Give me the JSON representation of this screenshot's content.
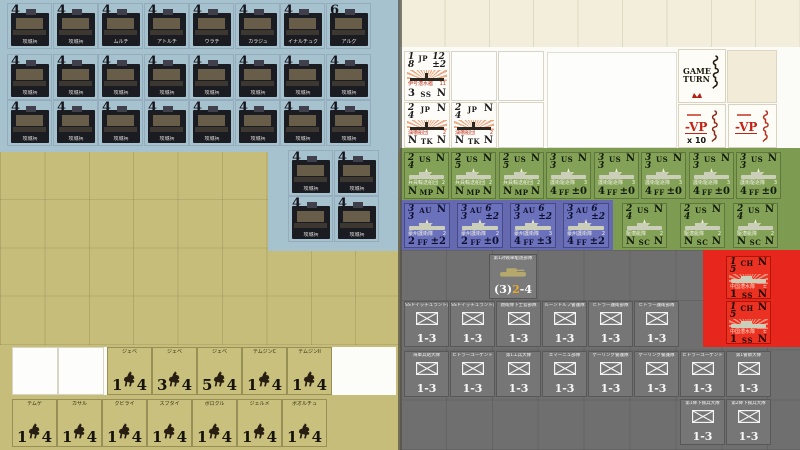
{
  "colors": {
    "blue": "#a7c2cf",
    "tan": "#c6bd7a",
    "cream": "#f3eedb",
    "green": "#7d9c51",
    "purple": "#656ab0",
    "gray": "#6f6f6f",
    "red": "#e7271d",
    "vp_red": "#c32218",
    "stat_yellow": "#e8a928"
  },
  "siege": {
    "row1": [
      {
        "v": "4",
        "name": "攻城兵"
      },
      {
        "v": "4",
        "name": "攻城兵"
      },
      {
        "v": "4",
        "name": "ムルチ"
      },
      {
        "v": "4",
        "name": "アトルチ"
      },
      {
        "v": "4",
        "name": "ウラチ"
      },
      {
        "v": "4",
        "name": "カラジュ"
      },
      {
        "v": "4",
        "name": "イナルチュク"
      },
      {
        "v": "6",
        "name": "アルグ"
      }
    ],
    "row2": [
      {
        "v": "4",
        "name": "攻城兵"
      },
      {
        "v": "4",
        "name": "攻城兵"
      },
      {
        "v": "4",
        "name": "攻城兵"
      },
      {
        "v": "4",
        "name": "攻城兵"
      },
      {
        "v": "4",
        "name": "攻城兵"
      },
      {
        "v": "4",
        "name": "攻城兵"
      },
      {
        "v": "4",
        "name": "攻城兵"
      },
      {
        "v": "4",
        "name": "攻城兵"
      }
    ],
    "row3": [
      {
        "v": "4",
        "name": "攻城兵"
      },
      {
        "v": "4",
        "name": "攻城兵"
      },
      {
        "v": "4",
        "name": "攻城兵"
      },
      {
        "v": "4",
        "name": "攻城兵"
      },
      {
        "v": "4",
        "name": "攻城兵"
      },
      {
        "v": "4",
        "name": "攻城兵"
      },
      {
        "v": "4",
        "name": "攻城兵"
      },
      {
        "v": "4",
        "name": "攻城兵"
      }
    ],
    "ext": [
      {
        "v": "4",
        "name": "攻城兵"
      },
      {
        "v": "4",
        "name": "攻城兵"
      },
      {
        "v": "4",
        "name": "攻城兵"
      },
      {
        "v": "4",
        "name": "攻城兵"
      }
    ]
  },
  "cavalry": {
    "row1": [
      {
        "name": "ジェベ",
        "a": "1",
        "m": "4"
      },
      {
        "name": "ジェベ",
        "a": "3",
        "m": "4"
      },
      {
        "name": "ジェベ",
        "a": "5",
        "m": "4"
      },
      {
        "name": "テムジンC",
        "a": "1",
        "m": "4"
      },
      {
        "name": "テムジンII",
        "a": "1",
        "m": "4"
      }
    ],
    "row2": [
      {
        "name": "テムゲ",
        "a": "1",
        "m": "4"
      },
      {
        "name": "カサル",
        "a": "1",
        "m": "4"
      },
      {
        "name": "クビライ",
        "a": "1",
        "m": "4"
      },
      {
        "name": "スブタイ",
        "a": "1",
        "m": "4"
      },
      {
        "name": "ボロクル",
        "a": "1",
        "m": "4"
      },
      {
        "name": "ジェルメ",
        "a": "1",
        "m": "4"
      },
      {
        "name": "ボオルチュ",
        "a": "1",
        "m": "4"
      }
    ]
  },
  "naval": {
    "jp": [
      {
        "tl": [
          "1",
          "8"
        ],
        "nat": "JP",
        "tr": [
          "12",
          "±2"
        ],
        "tiny": "伊号潜水艦",
        "tinyr": "11",
        "bl": "3",
        "code": "SS",
        "br": "N"
      },
      {
        "tl": [
          "2",
          "4"
        ],
        "nat": "JP",
        "tr": [
          "N"
        ],
        "tiny": "油槽船団",
        "tinyr": "2",
        "bl": "N",
        "code": "TK",
        "br": "N"
      },
      {
        "tl": [
          "2",
          "4"
        ],
        "nat": "JP",
        "tr": [
          "N"
        ],
        "tiny": "油槽船団",
        "tinyr": "2",
        "bl": "N",
        "code": "TK",
        "br": "N"
      }
    ],
    "us_row1": [
      {
        "tl": [
          "2",
          "4"
        ],
        "nat": "US",
        "tr": [
          "N"
        ],
        "tiny": "兵員輸送船団",
        "tinyr": "2",
        "bl": "N",
        "code": "MP",
        "br": "N"
      },
      {
        "tl": [
          "2",
          "5"
        ],
        "nat": "US",
        "tr": [
          "N"
        ],
        "tiny": "兵員輸送船団",
        "tinyr": "2",
        "bl": "N",
        "code": "MP",
        "br": "N"
      },
      {
        "tl": [
          "2",
          "5"
        ],
        "nat": "US",
        "tr": [
          "N"
        ],
        "tiny": "兵員輸送船団",
        "tinyr": "2",
        "bl": "N",
        "code": "MP",
        "br": "N"
      },
      {
        "tl": [
          "3",
          "3"
        ],
        "nat": "US",
        "tr": [
          "N"
        ],
        "tiny": "護衛駆逐隊",
        "tinyr": "3",
        "bl": "4",
        "code": "FF",
        "br": "±0"
      },
      {
        "tl": [
          "3",
          "3"
        ],
        "nat": "US",
        "tr": [
          "N"
        ],
        "tiny": "護衛駆逐隊",
        "tinyr": "3",
        "bl": "4",
        "code": "FF",
        "br": "±0"
      },
      {
        "tl": [
          "3",
          "3"
        ],
        "nat": "US",
        "tr": [
          "N"
        ],
        "tiny": "護衛駆逐隊",
        "tinyr": "3",
        "bl": "4",
        "code": "FF",
        "br": "±0"
      },
      {
        "tl": [
          "3",
          "3"
        ],
        "nat": "US",
        "tr": [
          "N"
        ],
        "tiny": "護衛駆逐隊",
        "tinyr": "3",
        "bl": "4",
        "code": "FF",
        "br": "±0"
      },
      {
        "tl": [
          "3",
          "3"
        ],
        "nat": "US",
        "tr": [
          "N"
        ],
        "tiny": "護衛駆逐隊",
        "tinyr": "3",
        "bl": "4",
        "code": "FF",
        "br": "±0"
      }
    ],
    "us_row2": [
      {
        "tl": [
          "2",
          "4"
        ],
        "nat": "US",
        "tr": [
          "N"
        ],
        "tiny": "駆潜艇隊",
        "tinyr": "2",
        "bl": "N",
        "code": "SC",
        "br": "N"
      },
      {
        "tl": [
          "2",
          "4"
        ],
        "nat": "US",
        "tr": [
          "N"
        ],
        "tiny": "駆潜艇隊",
        "tinyr": "2",
        "bl": "N",
        "code": "SC",
        "br": "N"
      },
      {
        "tl": [
          "2",
          "4"
        ],
        "nat": "US",
        "tr": [
          "N"
        ],
        "tiny": "駆潜艇隊",
        "tinyr": "2",
        "bl": "N",
        "code": "SC",
        "br": "N"
      }
    ],
    "au": [
      {
        "tl": [
          "3",
          "3"
        ],
        "nat": "AU",
        "tr": [
          "N"
        ],
        "tiny": "豪州護衛隊",
        "tinyr": "2",
        "bl": "2",
        "code": "FF",
        "br": "±2"
      },
      {
        "tl": [
          "3",
          "3"
        ],
        "nat": "AU",
        "tr": [
          "6",
          "±2"
        ],
        "tiny": "豪州護衛隊",
        "tinyr": "2",
        "bl": "2",
        "code": "FF",
        "br": "±0"
      },
      {
        "tl": [
          "3",
          "3"
        ],
        "nat": "AU",
        "tr": [
          "6",
          "±2"
        ],
        "tiny": "豪州護衛隊",
        "tinyr": "3",
        "bl": "4",
        "code": "FF",
        "br": "±3"
      },
      {
        "tl": [
          "3",
          "3"
        ],
        "nat": "AU",
        "tr": [
          "6",
          "±2"
        ],
        "tiny": "豪州護衛隊",
        "tinyr": "2",
        "bl": "4",
        "code": "FF",
        "br": "±2"
      }
    ],
    "ch": [
      {
        "tl": [
          "1",
          "5"
        ],
        "nat": "CH",
        "tr": [
          "N"
        ],
        "tiny": "中国潜水隊",
        "tinyr": "±",
        "bl": "1",
        "code": "SS",
        "br": "N"
      },
      {
        "tl": [
          "1",
          "5"
        ],
        "nat": "CH",
        "tr": [
          "N"
        ],
        "tiny": "中国潜水隊",
        "tinyr": "±",
        "bl": "1",
        "code": "SS",
        "br": "N"
      }
    ]
  },
  "tank": {
    "name": "第1対戦車駆逐部隊",
    "s1": "(3)",
    "s2": "2",
    "s3": "-4"
  },
  "infantry": {
    "value": "1-3",
    "row2": [
      "SSドイッチュラント連隊",
      "SSドイッチュラント連隊",
      "親衛隊下士官部隊",
      "ルーンドルフ警護隊",
      "ヒトラー護衛部隊",
      "ヒトラー護衛部隊"
    ],
    "row3": [
      "海軍兵站大隊",
      "ヒトラーユーゲント",
      "第1工兵大隊",
      "エマーニュ部隊",
      "ゲーリング警護隊",
      "ゲーリング警護隊",
      "ヒトラーユーゲント",
      "第1警察大隊"
    ],
    "row4": [
      "第1降下猟兵大隊",
      "第2降下猟兵大隊"
    ]
  },
  "markers": {
    "game_turn": {
      "line1": "GAME",
      "line2": "TURN"
    },
    "vp10": {
      "label": "-VP",
      "mult": "x 10"
    },
    "vp": {
      "label": "-VP"
    }
  }
}
